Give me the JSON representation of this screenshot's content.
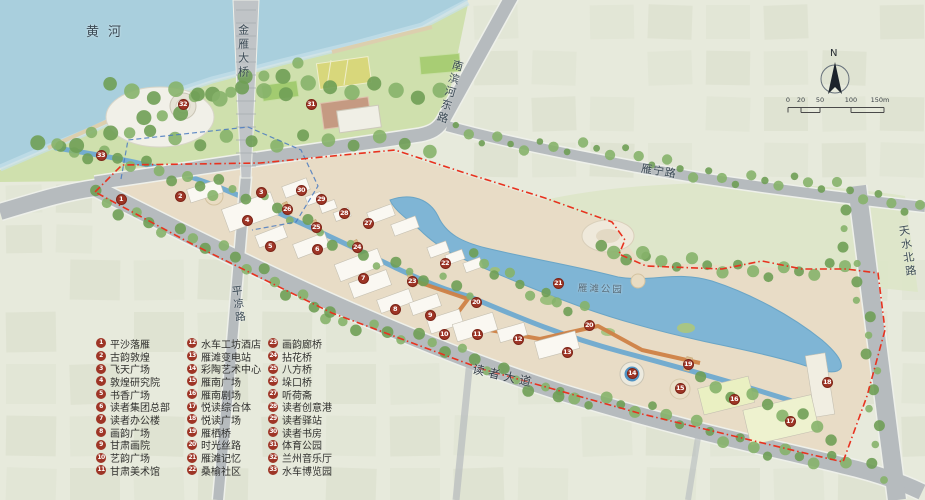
{
  "map": {
    "labels": [
      {
        "id": "yellow-river",
        "text": "黄河",
        "x": 86,
        "y": 26,
        "size": 13,
        "spacing": 9,
        "rot": 0,
        "vertical": false,
        "color": "#3b4a55"
      },
      {
        "id": "jinyan-bridge",
        "text": "金雁大桥",
        "x": 236,
        "y": 24,
        "size": 11,
        "spacing": 3,
        "rot": 0,
        "vertical": true,
        "color": "#3b4a55"
      },
      {
        "id": "nanbinhe-east-road",
        "text": "南滨河东路",
        "x": 452,
        "y": 58,
        "size": 11,
        "spacing": 2.5,
        "rot": 16,
        "vertical": true,
        "color": "#3b4a55"
      },
      {
        "id": "yanning-road",
        "text": "雁宁路",
        "x": 642,
        "y": 163,
        "size": 11,
        "spacing": 1,
        "rot": 9,
        "vertical": false,
        "color": "#3b4a55"
      },
      {
        "id": "pingliang-road",
        "text": "平凉路",
        "x": 230,
        "y": 286,
        "size": 10.5,
        "spacing": 2.5,
        "rot": -7,
        "vertical": true,
        "color": "#3b4a55"
      },
      {
        "id": "reader-avenue",
        "text": "读者大道",
        "x": 474,
        "y": 363,
        "size": 12,
        "spacing": 4,
        "rot": 13,
        "vertical": false,
        "color": "#39434c"
      },
      {
        "id": "tianshui-north-road",
        "text": "天水北路",
        "x": 896,
        "y": 226,
        "size": 11,
        "spacing": 2.5,
        "rot": -9,
        "vertical": true,
        "color": "#3b4a55"
      },
      {
        "id": "yantan-park",
        "text": "雁滩公园",
        "x": 578,
        "y": 284,
        "size": 9.5,
        "spacing": 2,
        "rot": 2,
        "vertical": false,
        "color": "#576b78"
      }
    ],
    "markers": [
      {
        "n": "1",
        "x": 121,
        "y": 199
      },
      {
        "n": "2",
        "x": 180,
        "y": 196
      },
      {
        "n": "3",
        "x": 261,
        "y": 192
      },
      {
        "n": "4",
        "x": 247,
        "y": 220
      },
      {
        "n": "5",
        "x": 270,
        "y": 246
      },
      {
        "n": "6",
        "x": 317,
        "y": 249
      },
      {
        "n": "7",
        "x": 363,
        "y": 278
      },
      {
        "n": "8",
        "x": 395,
        "y": 309
      },
      {
        "n": "9",
        "x": 430,
        "y": 315
      },
      {
        "n": "10",
        "x": 444,
        "y": 334
      },
      {
        "n": "11",
        "x": 477,
        "y": 334
      },
      {
        "n": "12",
        "x": 518,
        "y": 339
      },
      {
        "n": "13",
        "x": 567,
        "y": 352
      },
      {
        "n": "14",
        "x": 632,
        "y": 373
      },
      {
        "n": "15",
        "x": 680,
        "y": 388
      },
      {
        "n": "16",
        "x": 734,
        "y": 399
      },
      {
        "n": "17",
        "x": 790,
        "y": 421
      },
      {
        "n": "18",
        "x": 827,
        "y": 382
      },
      {
        "n": "19",
        "x": 688,
        "y": 364
      },
      {
        "n": "20",
        "x": 476,
        "y": 302
      },
      {
        "n": "20",
        "x": 589,
        "y": 325
      },
      {
        "n": "21",
        "x": 558,
        "y": 283
      },
      {
        "n": "22",
        "x": 445,
        "y": 263
      },
      {
        "n": "23",
        "x": 412,
        "y": 281
      },
      {
        "n": "24",
        "x": 357,
        "y": 247
      },
      {
        "n": "25",
        "x": 316,
        "y": 227
      },
      {
        "n": "26",
        "x": 287,
        "y": 209
      },
      {
        "n": "27",
        "x": 368,
        "y": 223
      },
      {
        "n": "28",
        "x": 344,
        "y": 213
      },
      {
        "n": "29",
        "x": 321,
        "y": 199
      },
      {
        "n": "30",
        "x": 301,
        "y": 190
      },
      {
        "n": "31",
        "x": 311,
        "y": 104
      },
      {
        "n": "32",
        "x": 183,
        "y": 104
      },
      {
        "n": "33",
        "x": 101,
        "y": 155
      }
    ],
    "compass": {
      "label": "N"
    },
    "scalebar": {
      "ticks": [
        "0",
        "20",
        "50",
        "100",
        "150m"
      ]
    }
  },
  "legend": {
    "columns": [
      [
        {
          "n": "1",
          "label": "平沙落雁"
        },
        {
          "n": "2",
          "label": "古韵敦煌"
        },
        {
          "n": "3",
          "label": "飞天广场"
        },
        {
          "n": "4",
          "label": "敦煌研究院"
        },
        {
          "n": "5",
          "label": "书香广场"
        },
        {
          "n": "6",
          "label": "读者集团总部"
        },
        {
          "n": "7",
          "label": "读者办公楼"
        },
        {
          "n": "8",
          "label": "画韵广场"
        },
        {
          "n": "9",
          "label": "甘肃画院"
        },
        {
          "n": "10",
          "label": "艺韵广场"
        },
        {
          "n": "11",
          "label": "甘肃美术馆"
        }
      ],
      [
        {
          "n": "12",
          "label": "水车工坊酒店"
        },
        {
          "n": "13",
          "label": "雁滩变电站"
        },
        {
          "n": "14",
          "label": "彩陶艺术中心"
        },
        {
          "n": "15",
          "label": "雁南广场"
        },
        {
          "n": "16",
          "label": "雁南剧场"
        },
        {
          "n": "17",
          "label": "悦读综合体"
        },
        {
          "n": "18",
          "label": "悦读广场"
        },
        {
          "n": "19",
          "label": "雁栖桥"
        },
        {
          "n": "20",
          "label": "时光丝路"
        },
        {
          "n": "21",
          "label": "雁滩记忆"
        },
        {
          "n": "22",
          "label": "桑榆社区"
        }
      ],
      [
        {
          "n": "23",
          "label": "画韵廊桥"
        },
        {
          "n": "24",
          "label": "拈花桥"
        },
        {
          "n": "25",
          "label": "八方桥"
        },
        {
          "n": "26",
          "label": "垛口桥"
        },
        {
          "n": "27",
          "label": "听荷斋"
        },
        {
          "n": "28",
          "label": "读者创意港"
        },
        {
          "n": "29",
          "label": "读者驿站"
        },
        {
          "n": "30",
          "label": "读者书房"
        },
        {
          "n": "31",
          "label": "体育公园"
        },
        {
          "n": "32",
          "label": "兰州音乐厅"
        },
        {
          "n": "33",
          "label": "水车博览园"
        }
      ]
    ]
  },
  "colors": {
    "water": "#a9cfdd",
    "lake": "#7fb5d5",
    "canal": "#74accf",
    "site": "#e8dcc6",
    "park": "#cfe0ad",
    "road": "#b6bbbe",
    "roadedge": "#eef0ea",
    "marker": "#9e3526",
    "boundary": "#e8321f",
    "silkroad": "#cf8146",
    "treeA": "#86b26a",
    "treeB": "#6f9f55"
  }
}
